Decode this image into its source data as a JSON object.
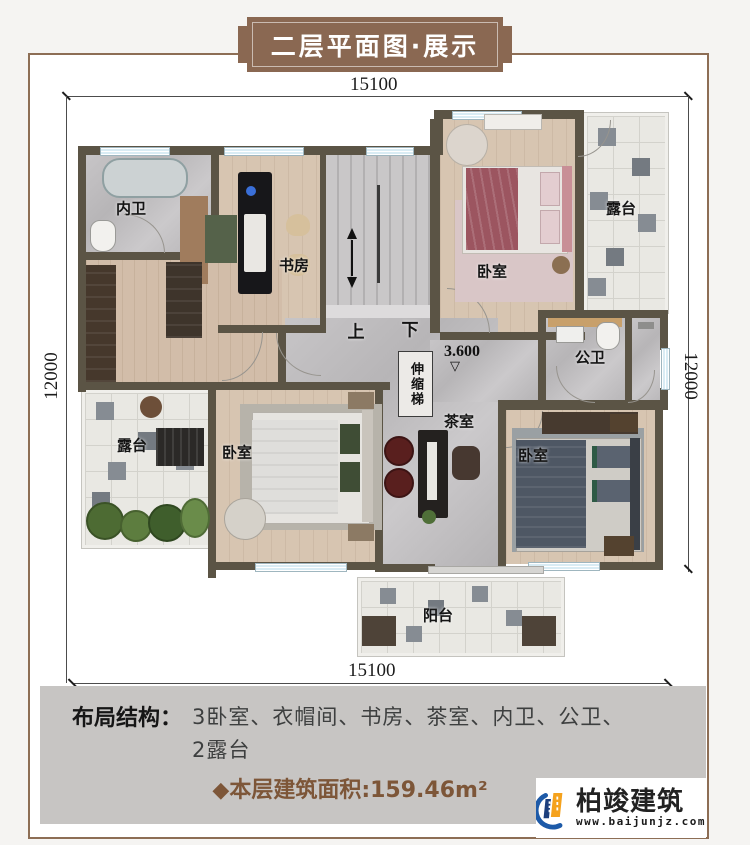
{
  "page": {
    "title": "二层平面图·展示"
  },
  "dimensions": {
    "top": "15100",
    "bottom": "15100",
    "left": "12000",
    "right": "12000"
  },
  "plan": {
    "rooms": [
      {
        "key": "bath-ensuite",
        "label": "内卫"
      },
      {
        "key": "study",
        "label": "书房"
      },
      {
        "key": "bedroom-ne",
        "label": "卧室"
      },
      {
        "key": "terrace-ne",
        "label": "露台"
      },
      {
        "key": "bath-public",
        "label": "公卫"
      },
      {
        "key": "terrace-w",
        "label": "露台"
      },
      {
        "key": "bedroom-sw",
        "label": "卧室"
      },
      {
        "key": "tea-room",
        "label": "茶室"
      },
      {
        "key": "bedroom-se",
        "label": "卧室"
      },
      {
        "key": "balcony",
        "label": "阳台"
      }
    ],
    "stairs": {
      "up": "上",
      "down": "下"
    },
    "level": "3.600",
    "level_symbol": "▽",
    "ladder": "伸缩梯"
  },
  "footer": {
    "layout_label": "布局结构：",
    "layout_line1": "3卧室、衣帽间、书房、茶室、内卫、公卫、",
    "layout_line2": "2露台",
    "area_text": "◆本层建筑面积:159.46m²"
  },
  "logo": {
    "name": "柏竣建筑",
    "url": "www.baijunjz.com"
  },
  "colors": {
    "accent_brown": "#8a6852",
    "wall": "#5b5445",
    "area_text": "#7d5638",
    "logo_blue": "#1d5aa8",
    "logo_orange": "#f5a21d"
  }
}
